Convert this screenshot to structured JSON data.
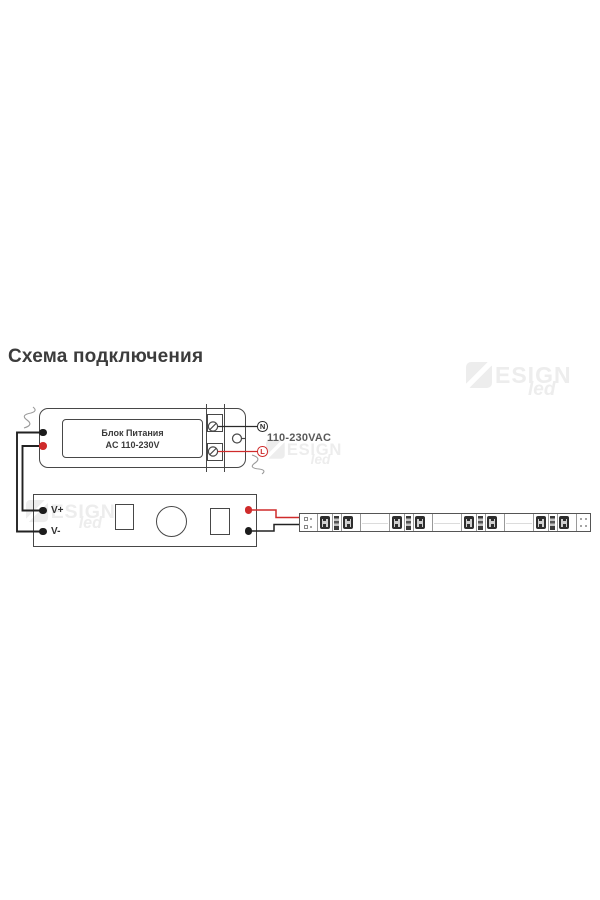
{
  "title": "Схема подключения",
  "watermark": {
    "brand": "ESIGN",
    "script": "led"
  },
  "psu": {
    "name_line1": "Блок Питания",
    "name_line2": "AC 110-230V",
    "terminal_neutral": "N",
    "terminal_line": "L",
    "mains_voltage_label": "110-230VAC"
  },
  "controller": {
    "positive_label": "V+",
    "negative_label": "V-"
  },
  "led_strip": {
    "segment_groups": 4,
    "leds_per_group": 2,
    "resistors_per_group": 1
  },
  "colors": {
    "wire_negative": "#222222",
    "wire_positive": "#cf2b2b",
    "outline": "#474747"
  }
}
